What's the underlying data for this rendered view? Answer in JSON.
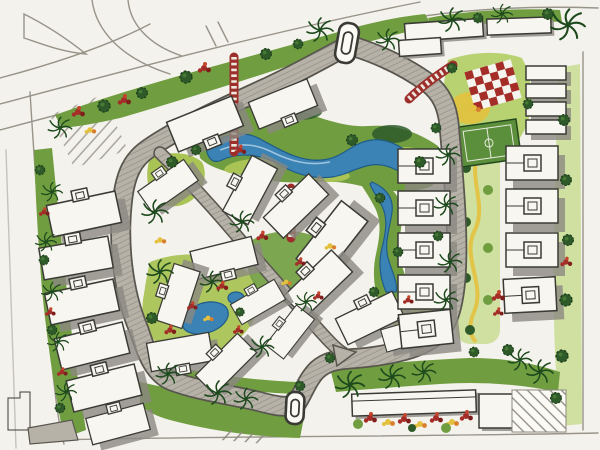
{
  "scene": {
    "kind": "hand-drawn landscape master plan (marker rendering, scanned)",
    "text_visible": "none"
  },
  "palette": {
    "paper": "#f4f2ec",
    "paper_bright": "#fbfaf5",
    "ink": "#3b3b36",
    "pencil": "#98948a",
    "road": "#b6b2a8",
    "road_edge": "#58564e",
    "building": "#f8f6f0",
    "shadow": "#8b8881",
    "green_dark": "#2e5a2a",
    "green_mid": "#6f9d3f",
    "green_soft": "#a9c355",
    "green_pale": "#cfe0a0",
    "water": "#3b82b5",
    "water_deep": "#1f5c8a",
    "red_flower": "#a52d28",
    "red_bridge": "#9c2f2c",
    "orange": "#d87e2c",
    "yellow": "#e3c13e",
    "court": "#5c8f3b"
  },
  "features": {
    "external_road": "pencil arterial road with slip lane and island, top-left",
    "loop_road": "gray internal loop road around the compound",
    "internal_road": "diagonal internal road to south entry",
    "north_gate": "oval gate island on north road",
    "south_gate": "oval gate island at south entry",
    "pedestrian_bridges": "red ladder-pattern crossings (3)",
    "water": "central winding stream, side stream, two ponds",
    "villas": "white footprints with entrance bumps and drop shadows",
    "rowhouses": "stacked rowhouse rows, east side",
    "playground": "red-white checkered play area in north-east park",
    "sports_court": "green court with white markings",
    "hatched_plots": "diagonal-hatched reserve areas",
    "planting": "perimeter hedges, palms, shade trees, flower beds"
  }
}
